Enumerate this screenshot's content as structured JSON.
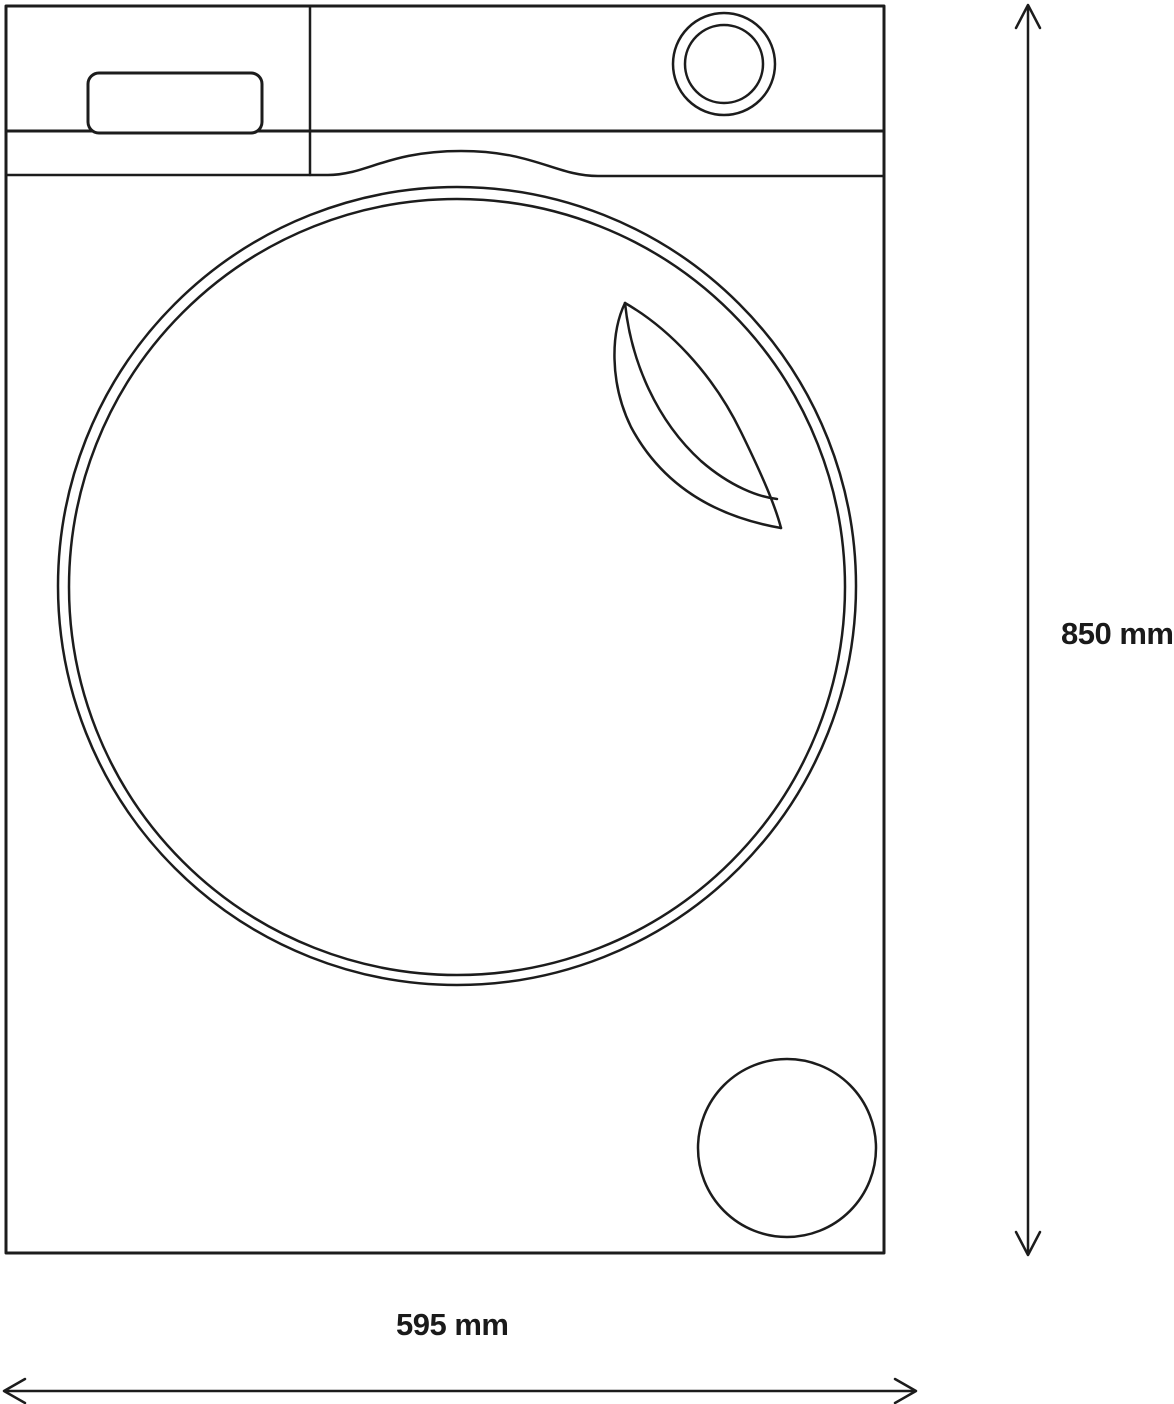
{
  "diagram": {
    "description": "Washing machine front view technical line drawing with overall dimensions",
    "background_color": "#ffffff",
    "line_color": "#1c1c1c",
    "height_dimension": {
      "label": "850 mm"
    },
    "width_dimension": {
      "label": "595 mm"
    }
  }
}
